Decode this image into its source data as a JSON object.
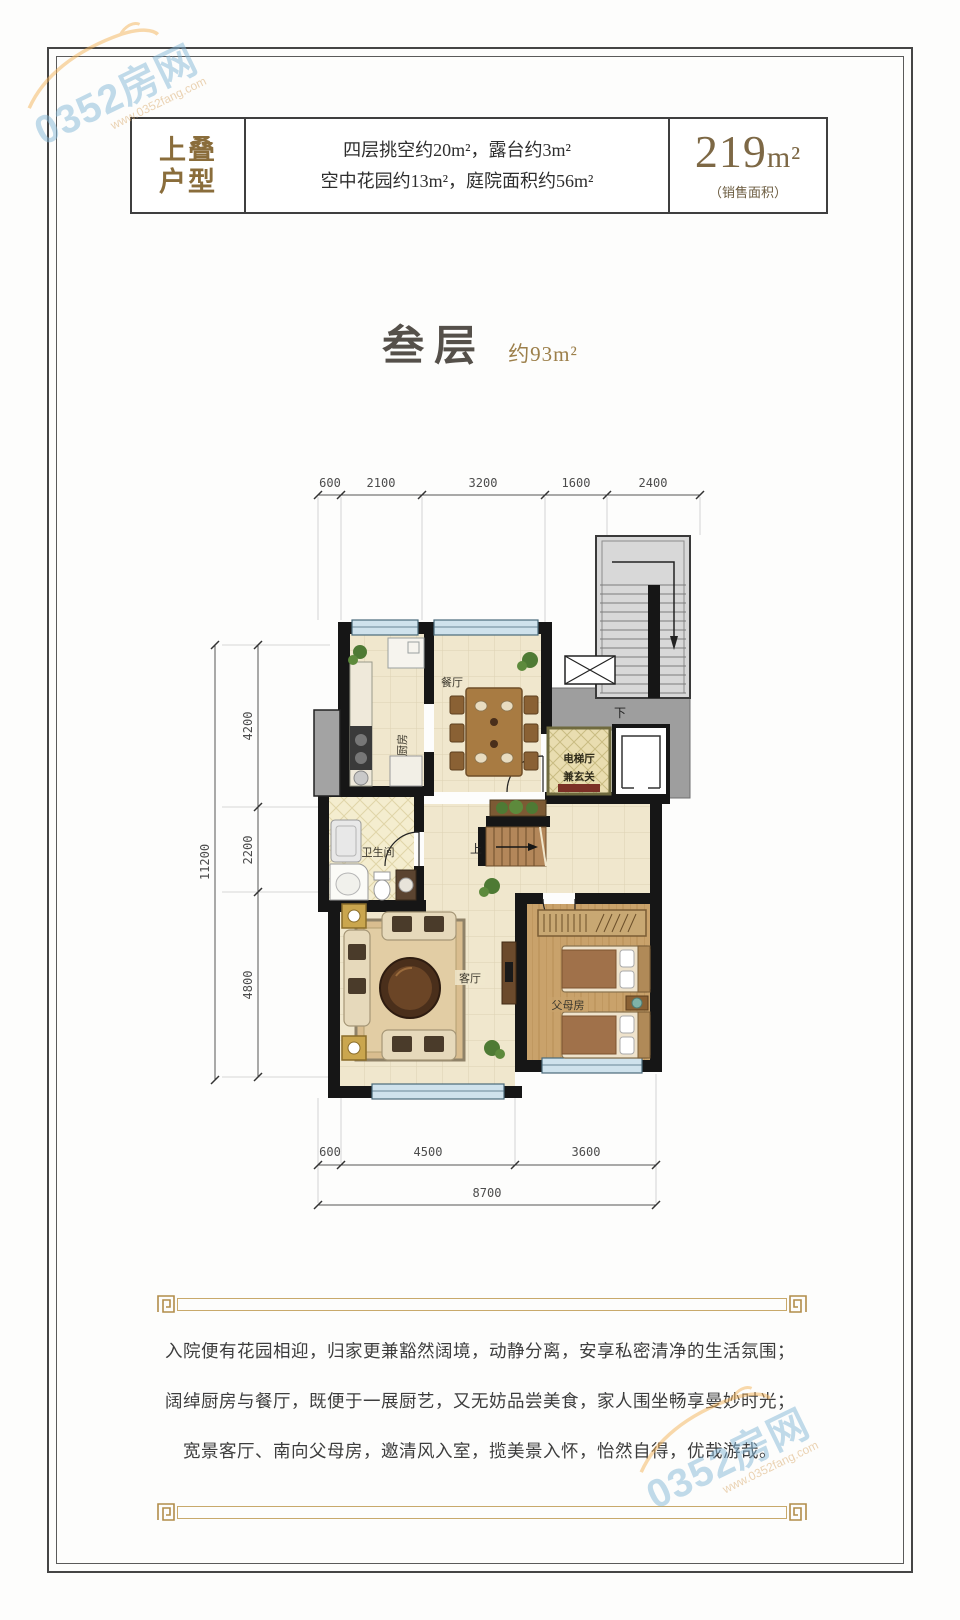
{
  "colors": {
    "gold_accent": "#8a6d3b",
    "wall": "#161616",
    "floor_tile": "#f0e7cd",
    "wood_floor": "#c9a26b",
    "elevator_hall": "#e9ddb0",
    "concrete": "#9e9e9e",
    "watermark_blue": "#85b8d8",
    "watermark_orange": "#f5b45a",
    "frame_gold": "#c8a96b"
  },
  "watermark": {
    "text": "0352房网",
    "url": "www.0352fang.com"
  },
  "header": {
    "tag_line1": "上叠",
    "tag_line2": "户型",
    "desc_line1": "四层挑空约20m²，露台约3m²",
    "desc_line2": "空中花园约13m²，庭院面积约56m²",
    "area_value": "219",
    "area_unit": "m²",
    "area_note": "（销售面积）"
  },
  "title": {
    "floor": "叁层",
    "area": "约93m²"
  },
  "floorplan": {
    "rooms": {
      "kitchen": "厨房",
      "dining": "餐厅",
      "elevator_hall_line1": "电梯厅",
      "elevator_hall_line2": "兼玄关",
      "bathroom": "卫生间",
      "living": "客厅",
      "parents": "父母房",
      "stairs_up": "上",
      "stairs_down": "下"
    },
    "dims_top": [
      "600",
      "2100",
      "3200",
      "1600",
      "2400"
    ],
    "dims_left_total": "11200",
    "dims_left": [
      "4200",
      "2200",
      "4800"
    ],
    "dims_bottom": [
      "600",
      "4500",
      "3600"
    ],
    "dims_bottom_total": "8700"
  },
  "description": {
    "line1": "入院便有花园相迎，归家更兼豁然阔境，动静分离，安享私密清净的生活氛围；",
    "line2": "阔绰厨房与餐厅，既便于一展厨艺，又无妨品尝美食，家人围坐畅享曼妙时光；",
    "line3": "宽景客厅、南向父母房，邀清风入室，揽美景入怀，怡然自得，优哉游哉。"
  }
}
